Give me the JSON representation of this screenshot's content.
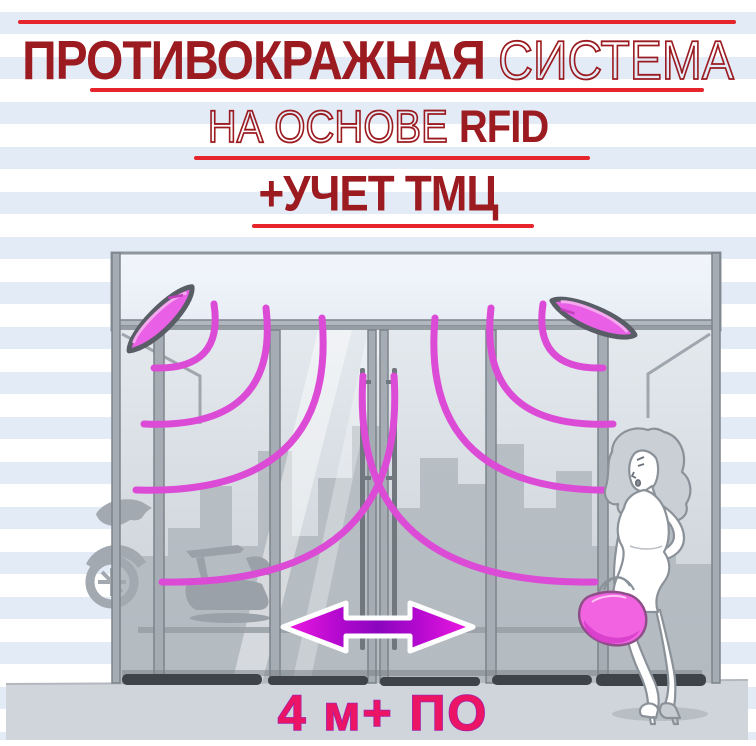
{
  "header": {
    "line1": {
      "bold": "ПРОТИВОКРАЖНАЯ",
      "thin": "СИСТЕМА"
    },
    "line2": {
      "thin": "НА ОСНОВЕ",
      "bold": "RFID"
    },
    "line3": {
      "bold": "+УЧЕТ ТМЦ"
    }
  },
  "illustration": {
    "caption": "4 м+ ПО",
    "scene": "storefront with sliding glass doors, two ceiling-mounted RFID reader antennas emitting signal waves, double-headed arrow showing door opening width, woman shopper with handbag",
    "icons": [
      "rfid-reader-left-icon",
      "rfid-reader-right-icon",
      "signal-waves-left-icon",
      "signal-waves-right-icon",
      "door-width-arrow-icon",
      "handbag-icon"
    ]
  },
  "colors": {
    "title_dark_red": "#9b1b21",
    "rule_red": "#e6242b",
    "stripe_blue": "#e3ebf7",
    "magenta_wave": "#dc4bd6",
    "antenna_magenta": "#e95fe5",
    "arrow_magenta": "#f11be2",
    "arrow_purple": "#8a06be",
    "caption_pink": "#ec1464",
    "caption_outline": "#a422aa",
    "ground_gray": "#cfd5da"
  }
}
